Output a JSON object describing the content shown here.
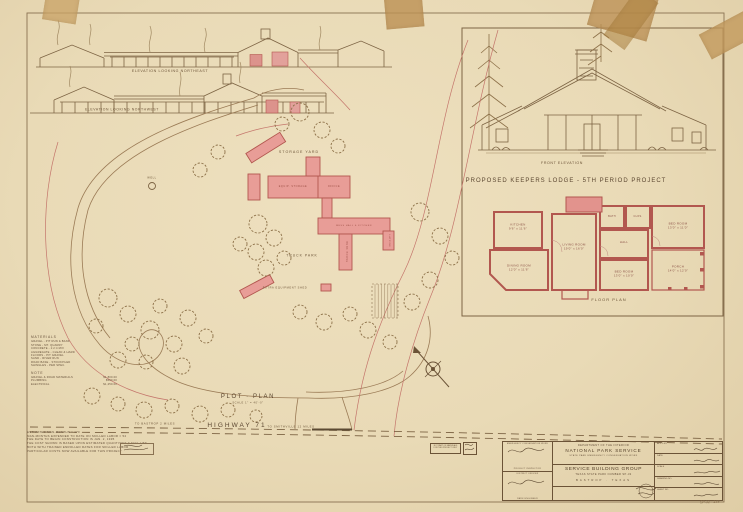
{
  "colors": {
    "paper": "#e9dab6",
    "pencil": "#6b5337",
    "red_pencil": "#c4756b",
    "building_pink": "#e89d97",
    "tape": "#c29a5e"
  },
  "elevations": {
    "northeast": "ELEVATION LOOKING NORTHEAST",
    "northwest": "ELEVATION LOOKING NORTHWEST"
  },
  "lodge": {
    "front_elevation_label": "FRONT ELEVATION",
    "title": "PROPOSED KEEPERS LODGE - 5TH PERIOD PROJECT",
    "floor_plan_label": "FLOOR PLAN",
    "rooms": [
      {
        "name": "KITCHEN",
        "dims": "9'6\" x 11'6\""
      },
      {
        "name": "DINING ROOM",
        "dims": "12'0\" x 11'6\""
      },
      {
        "name": "LIVING ROOM",
        "dims": "19'0\" x 16'0\""
      },
      {
        "name": "HALL",
        "dims": ""
      },
      {
        "name": "BATH",
        "dims": ""
      },
      {
        "name": "CLOS.",
        "dims": ""
      },
      {
        "name": "BED ROOM",
        "dims": "13'0\" x 11'0\""
      },
      {
        "name": "BED ROOM",
        "dims": "13'0\" x 10'0\""
      },
      {
        "name": "PORCH",
        "dims": "14'0\" x 12'0\""
      }
    ]
  },
  "plot": {
    "title": "PLOT · PLAN",
    "scale": "SCALE 1\" = 40'-0\"",
    "areas": {
      "storage_yard": "STORAGE YARD",
      "truck_park": "TRUCK PARK"
    },
    "buildings": {
      "equipment": "EQUIP. STORAGE",
      "office": "OFFICE",
      "mess": "MESS HALL & KITCHEN",
      "bunk": "BUNK HOUSE",
      "latrine": "LATRINE",
      "extra_shed": "EXTRA EQUIPMENT SHED",
      "well": "WELL"
    }
  },
  "highway": {
    "to_bastrop": "TO BASTROP 2 MILES",
    "name": "HIGHWAY 71",
    "to_smithville": "TO SMITHVILLE 12 MILES"
  },
  "legend": {
    "title": "MATERIALS",
    "items": [
      "GRAVEL - PIT RUN & BANK",
      "STONE - MT. QUARRY",
      "CONCRETE - 1:2:4 MIX",
      "AGGREGATE - CLEAN & HARD",
      "FLOORS - PIT GRAVEL",
      "SAND - RIVER RUN",
      "ROAD BASE - STOCKPILED",
      "SHINGLES - PER SPEC."
    ],
    "note_title": "NOTE",
    "note_items": [
      {
        "label": "GRAVEL & ROAD MATERIALS",
        "value": "$1,800.00"
      },
      {
        "label": "PLUMBING",
        "value": "$500.00"
      },
      {
        "label": "ELECTRICAL",
        "value": "$1,250.00"
      }
    ]
  },
  "notes": {
    "lines": [
      "ESTIMATED MAN-MONTHS = 170",
      "MAN-MONTHS EXPENDED TO DATE ON SKILLED LABOR = 54",
      "THE DATE TO BEGIN CONSTRUCTION IS JAN. 2, 1935",
      "THE COST SHOWN IS BASED UPON ESTIMATED QUANTITIES & FULL USE",
      "BOTH WITH TRAINED ENROLLED RATES FOR SKILLED LABOR",
      "PARTICULAR COSTS NOW AVAILABLE FOR THIS PROJECT"
    ]
  },
  "titleblock": {
    "dept": "DEPARTMENT OF THE INTERIOR",
    "agency": "NATIONAL PARK SERVICE",
    "sub": "STATE PARK EMERGENCY CONSERVATION WORK",
    "project": "SERVICE BUILDING GROUP",
    "park_line": "TEXAS STATE PARK NUMBER SP-32",
    "location": "BASTROP · TEXAS",
    "sig1_caption": "EMERGENCY CONSERVATION WORK",
    "sig1_role": "PROJECT INSPECTOR",
    "sig2_caption": "DISTRICT OFFICER",
    "sig2_role": "PARK ENGINEER",
    "right_rows": [
      {
        "label": "APP'D BY"
      },
      {
        "label": "DATE"
      },
      {
        "label": "SCALE"
      },
      {
        "label": "DRAWING NO."
      },
      {
        "label": "SHEET NO."
      }
    ],
    "corner_number": "SP.32 - 138"
  },
  "stamp": {
    "line1": "NOT PART OF MATERIALS",
    "line2": "FOR THIS PROJECT ONLY"
  }
}
